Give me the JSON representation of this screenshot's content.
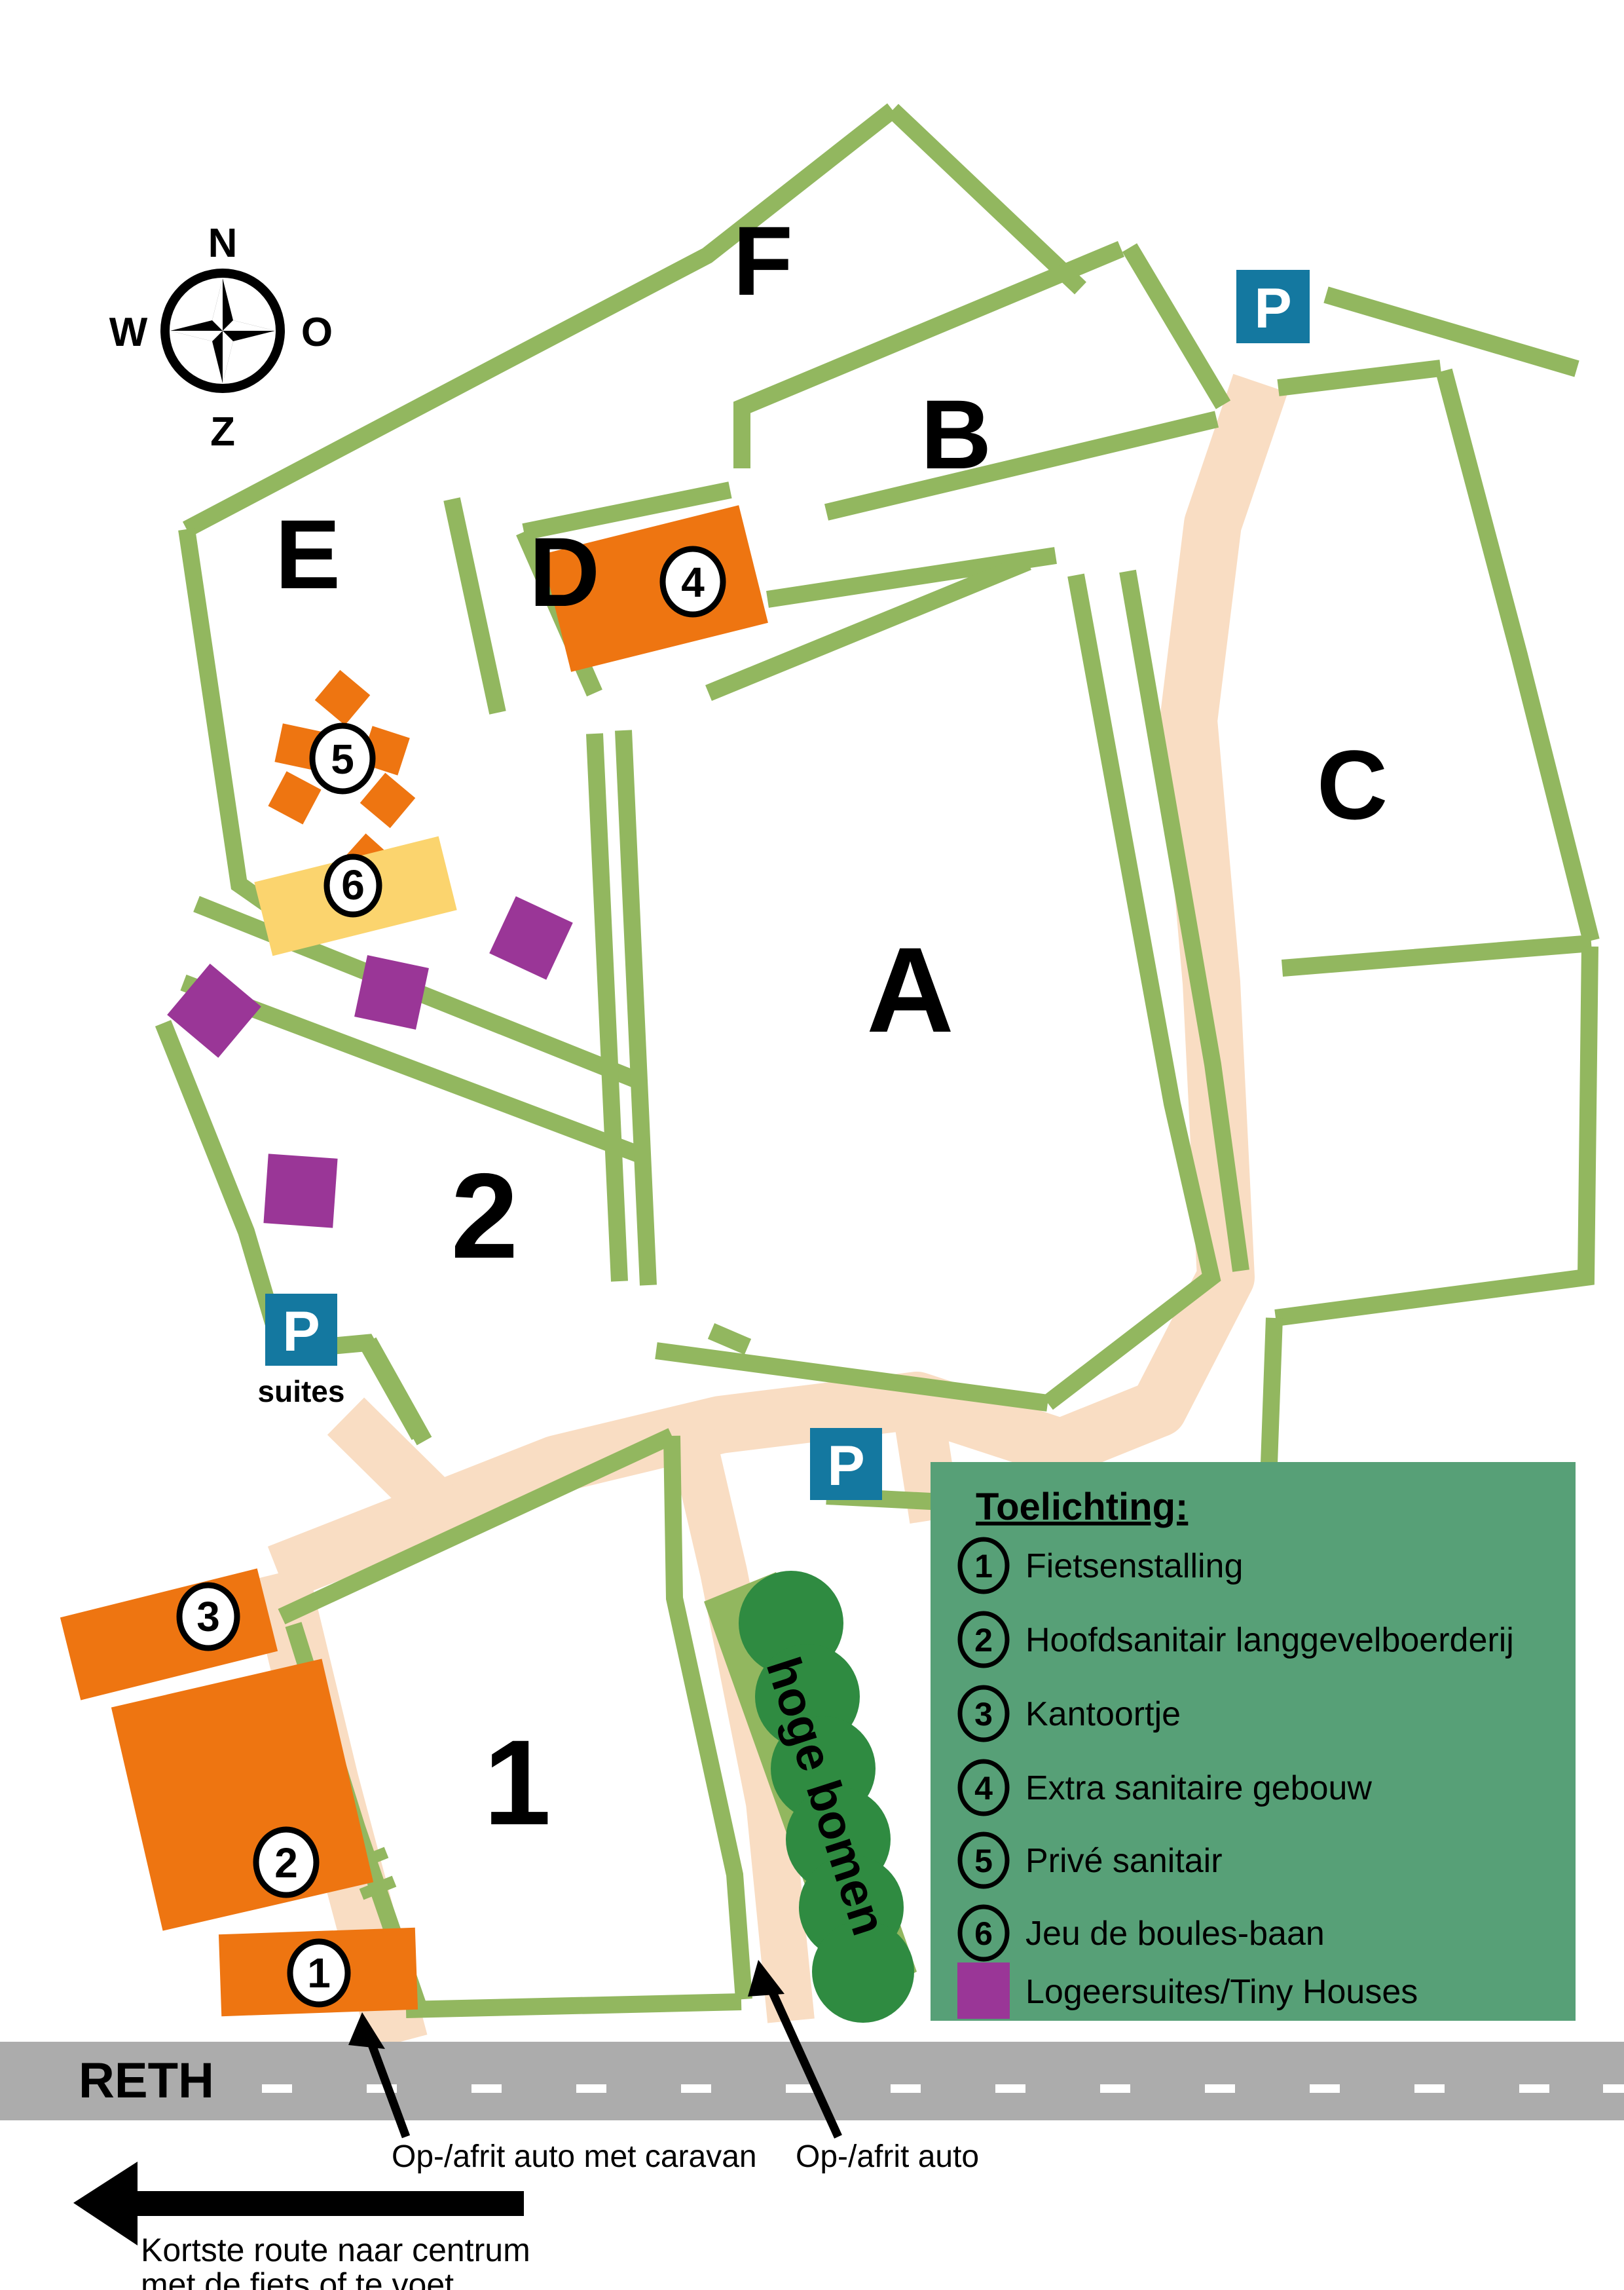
{
  "map": {
    "compass": {
      "north": "N",
      "west": "W",
      "east": "O",
      "south": "Z"
    },
    "field_labels": {
      "a": "A",
      "b": "B",
      "c": "C",
      "d": "D",
      "e": "E",
      "f": "F",
      "one": "1",
      "two": "2"
    },
    "markers": {
      "m1": "1",
      "m2": "2",
      "m3": "3",
      "m4": "4",
      "m5": "5",
      "m6": "6"
    },
    "parking": {
      "p_top": "P",
      "p_mid": "P",
      "p_suites": "P",
      "suites_label": "suites"
    },
    "trees_label": "hoge bomen",
    "road_name": "RETH"
  },
  "legend": {
    "title": "Toelichting:",
    "items": [
      {
        "num": "1",
        "label": "Fietsenstalling"
      },
      {
        "num": "2",
        "label": "Hoofdsanitair langgevelboerderij"
      },
      {
        "num": "3",
        "label": "Kantoortje"
      },
      {
        "num": "4",
        "label": "Extra sanitaire gebouw"
      },
      {
        "num": "5",
        "label": "Privé sanitair"
      },
      {
        "num": "6",
        "label": "Jeu de boules-baan"
      }
    ],
    "tiny_houses_label": "Logeersuites/Tiny Houses"
  },
  "annotations": {
    "caravan_entry": "Op-/afrit auto met caravan",
    "auto_entry": "Op-/afrit auto",
    "route_line1": "Kortste route naar centrum",
    "route_line2": "met de fiets of te voet"
  },
  "colors": {
    "path_green": "#92B75F",
    "legend_green": "#57A077",
    "tree_green": "#2F8B41",
    "orange": "#EE7511",
    "yellow": "#FBD46E",
    "purple": "#9A3697",
    "parking_blue": "#1478A0",
    "road_peach": "#F9DDC3",
    "street_gray": "#ACACAC"
  }
}
